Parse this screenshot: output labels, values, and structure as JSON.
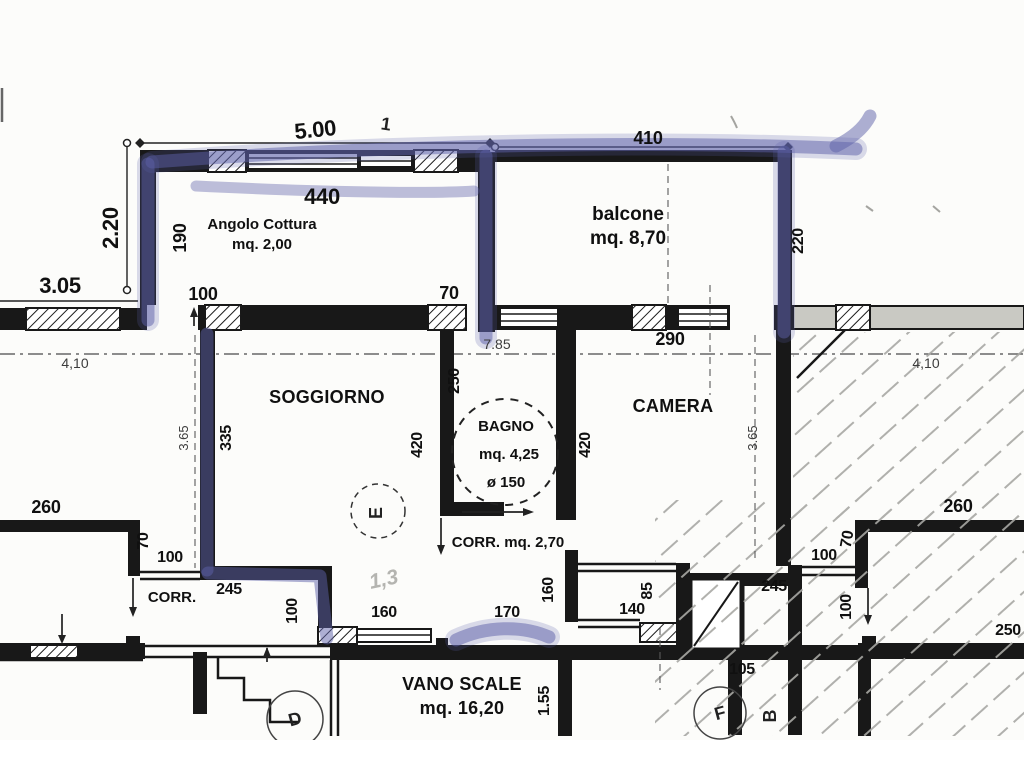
{
  "meta": {
    "type": "scanned floor plan",
    "language": "it"
  },
  "colors": {
    "highlighter": "#5c5fa8",
    "wall": "#181818",
    "pencil_hatch": "#a8a8a4",
    "paper": "#fcfcfa"
  },
  "rooms": {
    "angolo_cottura": {
      "name": "Angolo Cottura",
      "area": "mq. 2,00"
    },
    "balcone": {
      "name": "balcone",
      "area": "mq. 8,70"
    },
    "soggiorno": {
      "name": "SOGGIORNO"
    },
    "bagno": {
      "name": "BAGNO",
      "area": "mq. 4,25",
      "diameter": "ø 150"
    },
    "camera": {
      "name": "CAMERA"
    },
    "corridoio": {
      "name": "CORR.",
      "area_label": "CORR. mq. 2,70"
    },
    "vano_scale": {
      "name": "VANO SCALE",
      "area": "mq. 16,20"
    }
  },
  "dims": {
    "top_overall": "5.00",
    "balcone_top": "410",
    "cottura_top": "440",
    "left_height": "2.20",
    "cottura_left": "190",
    "left_wing": "3.05",
    "cottura_door": "100",
    "divider_door": "70",
    "balcone_right": "220",
    "ref_left": "4,10",
    "ref_mid": "7.85",
    "camera_top": "290",
    "ref_right": "4,10",
    "soggiorno_left": "335",
    "soggiorno_ref": "3.65",
    "bagno_left": "250",
    "bagno_wall": "420",
    "camera_wall": "420",
    "camera_ref": "3.65",
    "room_left_top": "260",
    "corr_left_wall": "70",
    "corr_left_door": "100",
    "corr_left": "245",
    "corr_left_v": "100",
    "scale_door_left": "160",
    "scale_door": "170",
    "scale_wall_v": "160",
    "corr_right_opening": "85",
    "scale_door_right": "140",
    "scale_depth": "1.55",
    "corr_right_wall": "105",
    "corr_right": "245",
    "corr_right_door": "100",
    "corr_right_wall_v": "70",
    "room_right_top": "260",
    "corr_right_v": "100",
    "room_right_side": "250"
  },
  "annotations": {
    "pencil_note": "1,3",
    "tick": "1",
    "marker_e": "E",
    "marker_d": "D",
    "marker_f": "F",
    "marker_b": "B"
  }
}
